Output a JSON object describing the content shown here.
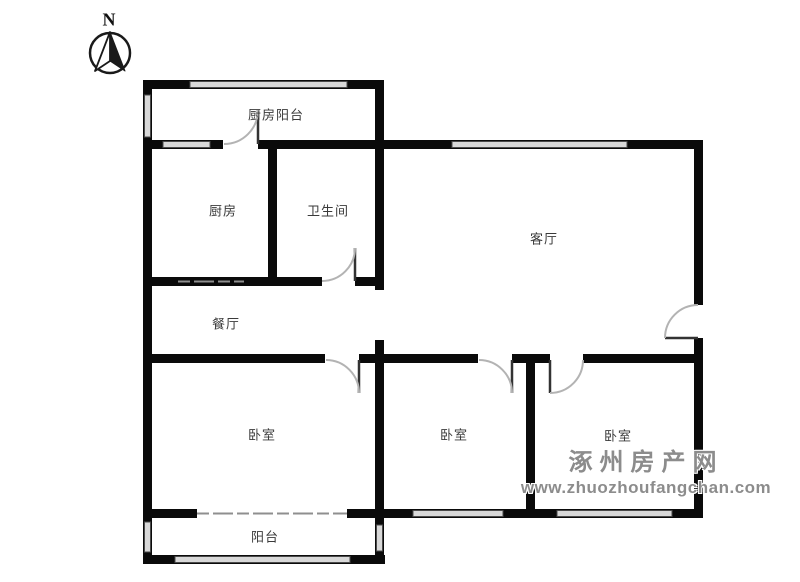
{
  "floorplan": {
    "compass": {
      "label": "N"
    },
    "rooms": [
      {
        "id": "kitchen-balcony",
        "label": "厨房阳台"
      },
      {
        "id": "kitchen",
        "label": "厨房"
      },
      {
        "id": "bathroom",
        "label": "卫生间"
      },
      {
        "id": "living-room",
        "label": "客厅"
      },
      {
        "id": "dining-room",
        "label": "餐厅"
      },
      {
        "id": "bedroom-1",
        "label": "卧室"
      },
      {
        "id": "bedroom-2",
        "label": "卧室"
      },
      {
        "id": "bedroom-3",
        "label": "卧室"
      },
      {
        "id": "balcony",
        "label": "阳台"
      }
    ],
    "watermark": {
      "site_name": "涿州房产网",
      "site_url": "www.zhuozhoufangchan.com"
    },
    "colors": {
      "wall": "#0a0a0a",
      "window_fill": "#d8d8d8",
      "window_edge": "#4a4a4a",
      "door_arc": "#b3b3b3",
      "door_panel": "#333333",
      "thin_line": "#8f8f8f",
      "label": "#3a3a3a",
      "watermark": "#8c8c8c"
    }
  }
}
